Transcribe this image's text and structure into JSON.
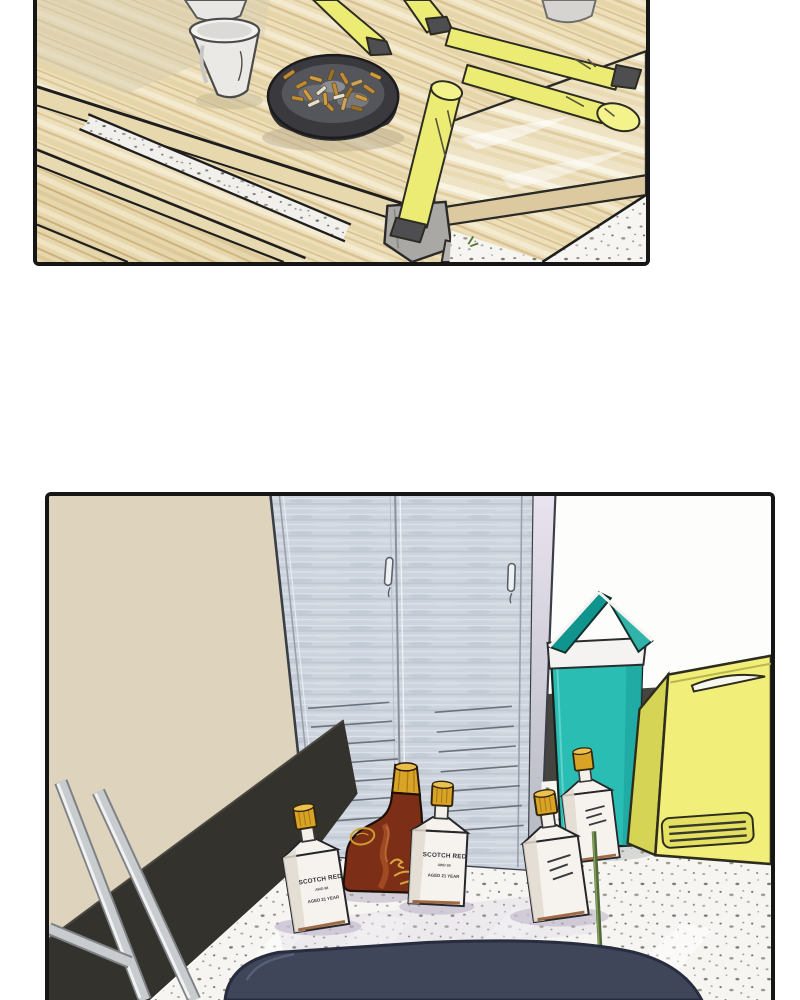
{
  "page": {
    "background": "#ffffff",
    "kind": "two-panel comic page"
  },
  "panels": {
    "table_scene": {
      "name": "wooden table corner",
      "objects": [
        "paper-cup-back",
        "paper-cup-front",
        "paper-cup-right",
        "ashtray-with-cigarette-butts",
        "yellow-sticks",
        "wood-plank",
        "metal-bracket",
        "terrazzo-floor"
      ]
    },
    "locker_scene": {
      "name": "locker room corner",
      "objects": [
        "beige-wall",
        "steel-locker",
        "teal-trash-can",
        "yellow-carry-box",
        "whisky-bottles",
        "green-rod",
        "chair-frame",
        "navy-seat",
        "terrazzo-floor"
      ]
    }
  },
  "bottle_label": {
    "brand": "SCOTCH RED",
    "series": "AWD 88",
    "aged": "AGED 21 YEAR"
  },
  "colors": {
    "panel_border": "#161616",
    "wood": "#ecdfba",
    "wood_streak": "#d9c291",
    "ashtray_dark": "#3a3a3e",
    "cigarette_butt": "#c08a36",
    "stick_yellow": "#ecec74",
    "wall_beige": "#ded4bd",
    "baseboard_dark": "#34322c",
    "locker_gray": "#cdd4de",
    "trash_can_teal": "#2abdb4",
    "box_yellow": "#f1ee79",
    "bottle_amber": "#7c2f16",
    "cap_gold": "#d9a326",
    "seat_navy": "#3f4659",
    "floor_white": "#f6f5f2"
  }
}
